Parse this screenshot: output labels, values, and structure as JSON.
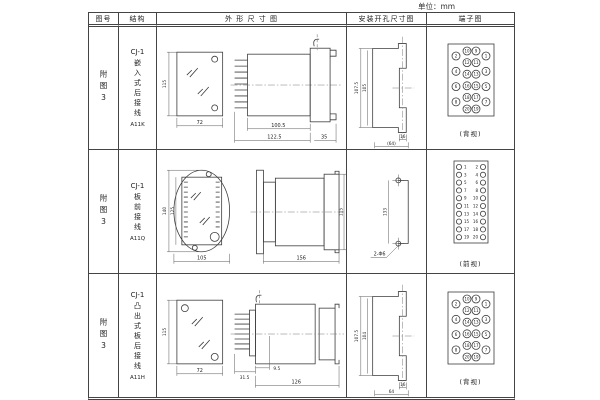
{
  "unit_label": "单位：mm",
  "header": {
    "fig_no": "图号",
    "structure": "结构",
    "outline": "外 形 尺 寸 图",
    "mounting": "安装开孔尺寸图",
    "terminal": "端子图"
  },
  "rows": [
    {
      "fig_no": "附图3",
      "structure": {
        "model": "CJ-1",
        "desc": "嵌入式后接线",
        "code": "A11K"
      },
      "outline_dims": {
        "front_height": "115",
        "front_width": "72",
        "body_depth": "100.5",
        "total_depth": "122.5",
        "flange_depth": "35"
      },
      "mounting_dims": {
        "outer_height": "107.5",
        "inner_height": "105",
        "slot_width": "16",
        "overall_width": "(64)"
      },
      "terminal": {
        "type": "grid",
        "columns": [
          [
            2,
            4,
            6,
            8
          ],
          [
            10,
            12,
            14,
            16,
            18,
            20
          ],
          [
            9,
            11,
            13,
            15,
            17,
            19
          ],
          [
            1,
            3,
            5,
            7
          ]
        ],
        "view_label": "(背视)"
      }
    },
    {
      "fig_no": "附图3",
      "structure": {
        "model": "CJ-1",
        "desc": "板前接线",
        "code": "A11Q"
      },
      "outline_dims": {
        "front_outer_height": "140",
        "front_inner_height": "125",
        "front_width": "105",
        "body_depth": "156",
        "rear_height": "115"
      },
      "mounting_dims": {
        "hole_spacing": "133",
        "hole_label": "2-Φ6"
      },
      "terminal": {
        "type": "strip",
        "left": [
          1,
          3,
          5,
          7,
          9,
          11,
          13,
          15,
          17,
          19
        ],
        "right": [
          2,
          4,
          6,
          8,
          10,
          12,
          14,
          16,
          18,
          20
        ],
        "view_label": "(前视)"
      }
    },
    {
      "fig_no": "附图3",
      "structure": {
        "model": "CJ-1",
        "desc": "凸出式板后接线",
        "code": "A11H"
      },
      "outline_dims": {
        "front_height": "115",
        "front_width": "72",
        "comb_depth": "31.5",
        "gap_depth": "9.5",
        "body_depth": "126"
      },
      "mounting_dims": {
        "outer_height": "107.5",
        "inner_height": "104",
        "slot_width": "16",
        "overall_width": "64"
      },
      "terminal": {
        "type": "grid",
        "columns": [
          [
            2,
            4,
            6,
            8
          ],
          [
            10,
            12,
            14,
            16,
            18,
            20
          ],
          [
            9,
            11,
            13,
            15,
            17,
            19
          ],
          [
            1,
            3,
            5,
            7
          ]
        ],
        "view_label": "(背视)"
      }
    }
  ]
}
